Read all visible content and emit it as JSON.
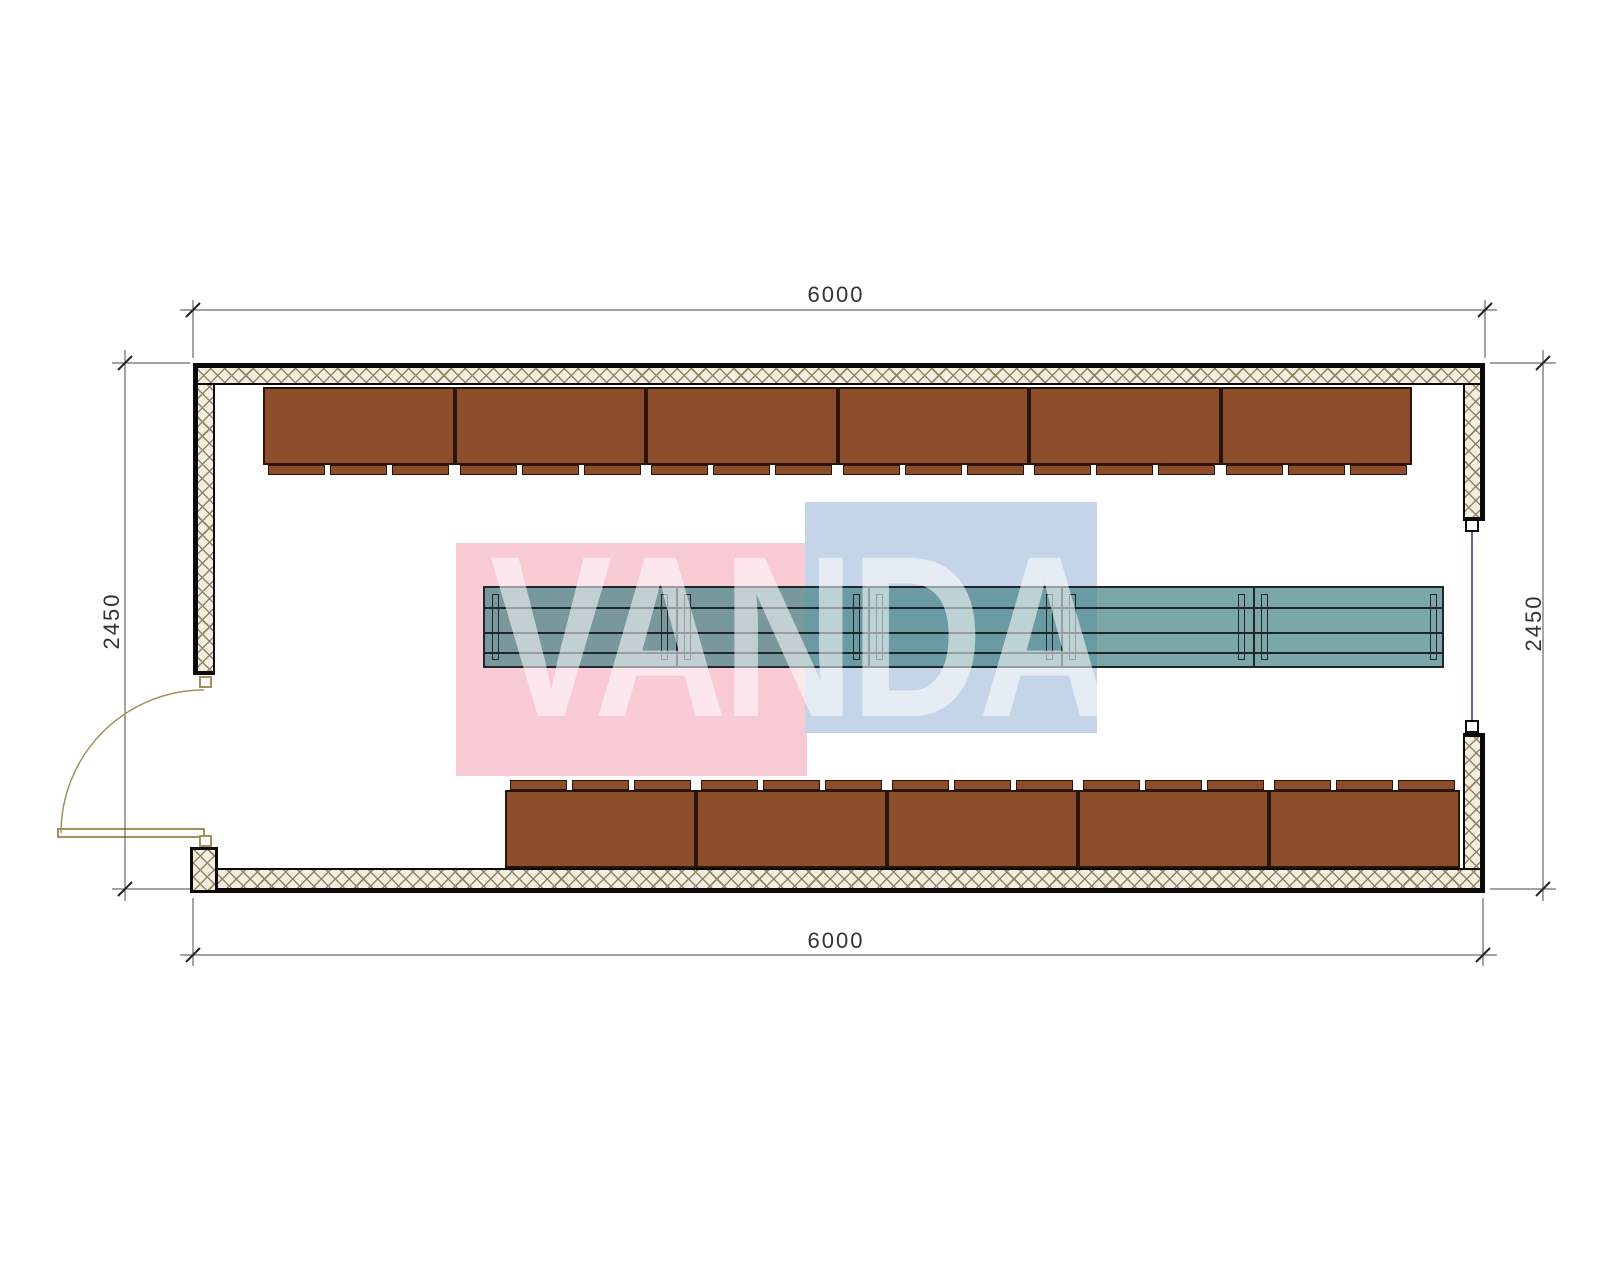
{
  "dimensions": {
    "top": "6000",
    "bottom": "6000",
    "left": "2450",
    "right": "2450"
  },
  "watermark": {
    "text": "VANDA"
  },
  "colors": {
    "wall_line": "#0a0a0a",
    "wall_hatch_bg": "#F3EEDF",
    "wall_hatch_line": "#8F8566",
    "bench_fill": "#8C4D2B",
    "bench_line": "#2B150A",
    "table_fill": "rgba(72,133,136,0.72)",
    "table_line": "#1F272B",
    "dim_line": "#4a4a4a",
    "dim_text": "#333333",
    "door_line": "#A3915A",
    "window_line": "#2A3580",
    "wm_pink": "#F8CAD4",
    "wm_blue": "#C5D4E7",
    "wm_text": "rgba(255,255,255,0.55)"
  },
  "plan": {
    "bench_rows": [
      {
        "id": "top",
        "count": 6,
        "x": 263,
        "y": 387,
        "width": 1149,
        "height": 78,
        "tab_side": "bottom",
        "tab_height": 10,
        "tabs_per_bench": 3
      },
      {
        "id": "bottom",
        "count": 5,
        "x": 505,
        "y": 790,
        "width": 955,
        "height": 78,
        "tab_side": "top",
        "tab_height": 10,
        "tabs_per_bench": 3
      }
    ],
    "table": {
      "x": 483,
      "y": 586,
      "width": 961,
      "height": 82,
      "sections": 5,
      "row_lines": [
        19,
        44,
        64
      ]
    },
    "watermark_rects": {
      "pink": {
        "x": 456,
        "y": 543,
        "width": 351,
        "height": 233
      },
      "blue": {
        "x": 805,
        "y": 502,
        "width": 292,
        "height": 231
      }
    }
  }
}
